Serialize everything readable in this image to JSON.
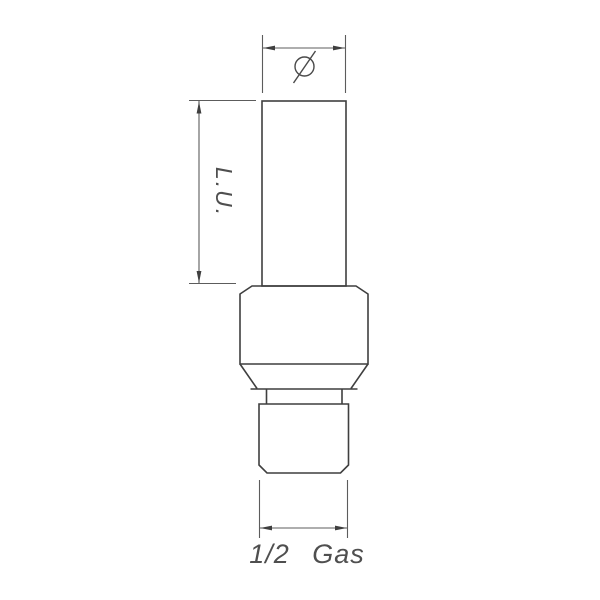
{
  "page": {
    "background_color": "#ffffff",
    "kind": "mechanical technical drawing of a threaded fitting"
  },
  "drawing": {
    "colors": {
      "part_outline": "#3f3f3f",
      "dimension_lines": "#5c5c5c",
      "text": "#4f4f4f"
    },
    "icons": {
      "diameter": {
        "name": "diameter-symbol-icon",
        "symbol": "Ø",
        "description": "circle with diagonal slash marking the tube outer diameter"
      }
    },
    "dimensions": {
      "diameter": {
        "symbol": "Ø",
        "position": "top",
        "measures": "outer diameter of upper tube"
      },
      "length": {
        "label": "L.U.",
        "position": "left",
        "orientation": "rotated 90deg clockwise",
        "measures": "length of upper tube"
      },
      "thread": {
        "label": "1/2 Gas",
        "position": "bottom",
        "measures": "thread size of lower connector"
      }
    }
  }
}
